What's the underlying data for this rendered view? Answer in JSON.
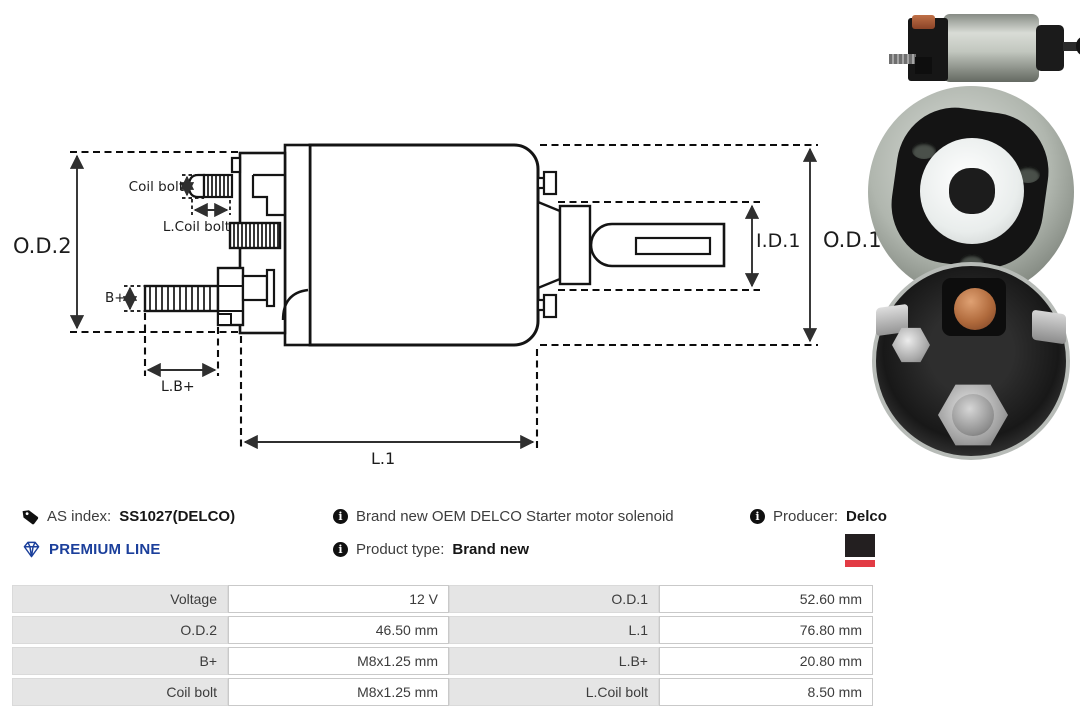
{
  "product": {
    "as_index_label": "AS index:",
    "as_index_value": "SS1027(DELCO)",
    "premium_line": "PREMIUM LINE",
    "description": "Brand new OEM DELCO Starter motor solenoid",
    "product_type_label": "Product type:",
    "product_type_value": "Brand new",
    "producer_label": "Producer:",
    "producer_value": "Delco"
  },
  "diagram": {
    "labels": {
      "od2": "O.D.2",
      "od1": "O.D.1",
      "id1": "I.D.1",
      "l1": "L.1",
      "bplus": "B+",
      "lbplus": "L.B+",
      "coil_bolt": "Coil bolt",
      "l_coil_bolt": "L.Coil bolt"
    }
  },
  "photos": [
    {
      "name": "solenoid side view"
    },
    {
      "name": "solenoid cap view"
    },
    {
      "name": "solenoid terminal view"
    }
  ],
  "specs": {
    "rows": [
      {
        "label1": "Voltage",
        "value1": "12 V",
        "label2": "O.D.1",
        "value2": "52.60 mm"
      },
      {
        "label1": "O.D.2",
        "value1": "46.50 mm",
        "label2": "L.1",
        "value2": "76.80 mm"
      },
      {
        "label1": "B+",
        "value1": "M8x1.25 mm",
        "label2": "L.B+",
        "value2": "20.80 mm"
      },
      {
        "label1": "Coil bolt",
        "value1": "M8x1.25 mm",
        "label2": "L.Coil bolt",
        "value2": "8.50 mm"
      }
    ]
  },
  "colors": {
    "premium_blue": "#1b3f9b",
    "logo_black": "#231f20",
    "logo_red": "#e23b44"
  }
}
